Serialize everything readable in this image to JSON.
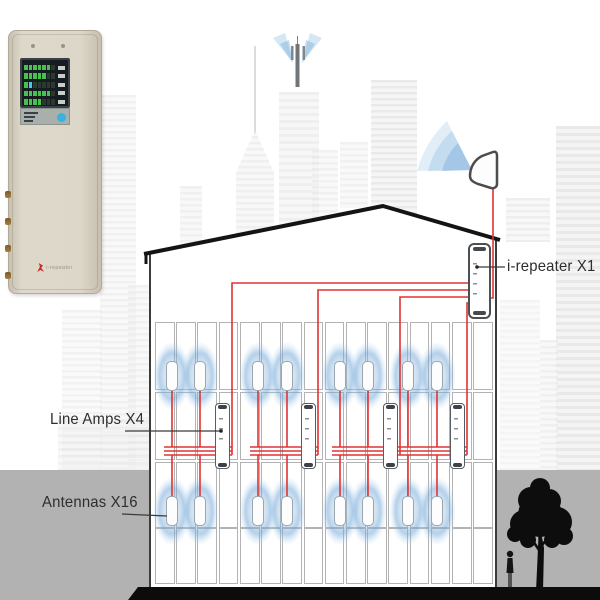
{
  "labels": {
    "repeater": "i-repeater X1",
    "line_amps": "Line Amps X4",
    "antennas": "Antennas X16"
  },
  "device_panel": {
    "logo_text": "i-repeater",
    "led_rows": 5,
    "led_lit": [
      6,
      5,
      1,
      6,
      4
    ]
  },
  "colors": {
    "cable": "#e03434",
    "halo": "#7eadd6",
    "ground": "#b2b2b2",
    "roof": "#141414",
    "silhouette": "#0d0d0d",
    "led_green": "#46c24e",
    "button_blue": "#38b2e0",
    "label_text": "#2e2e2e"
  },
  "diagram": {
    "antenna_count": 16,
    "line_amp_count": 4,
    "repeater_count": 1,
    "antenna_columns": [
      172,
      200,
      258,
      287,
      340,
      368,
      408,
      437
    ],
    "antenna_rows_y": [
      361,
      496
    ],
    "line_amp_x": [
      222,
      308,
      390,
      457
    ],
    "line_amp_y": 403,
    "feed_x": [
      232,
      318,
      400,
      467
    ],
    "feed_top_y": [
      283,
      290,
      297,
      303
    ],
    "bundle_y": [
      447,
      451,
      455
    ],
    "repeater_pos": {
      "x": 468,
      "y": 243
    },
    "donor_cable_x": 493,
    "floors": [
      {
        "y": 322,
        "h": 66
      },
      {
        "y": 392,
        "h": 66
      },
      {
        "y": 462,
        "h": 64
      },
      {
        "y": 528,
        "h": 54
      }
    ],
    "building": {
      "left": 150,
      "right": 496,
      "apex_x": 383,
      "apex_y": 206,
      "eave_left_y": 253,
      "eave_right_y": 239,
      "base_y": 592
    }
  }
}
